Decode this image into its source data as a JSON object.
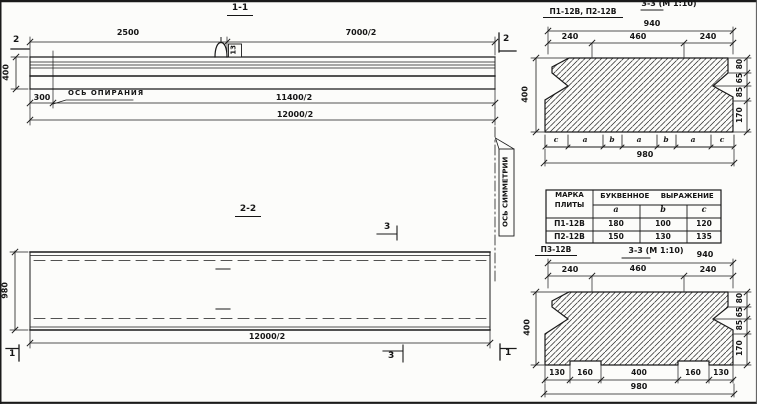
{
  "section_1_1": {
    "title": "1-1",
    "dim_left_span": "2500",
    "dim_right_span": "7000/2",
    "loop_mark": "13",
    "height_dim": "400",
    "support_offset_dim": "300",
    "support_axis_label": "ОСЬ ОПИРАНИЯ",
    "dim_support_span": "11400/2",
    "dim_total": "12000/2",
    "cut_marker_left": "2",
    "cut_marker_right": "2"
  },
  "section_2_2": {
    "title": "2-2",
    "width_dim": "980",
    "dim_total": "12000/2",
    "cut_marker_left": "1",
    "cut_marker_right": "1",
    "cut_marker_top": "3",
    "cut_marker_bottom": "3",
    "symmetry_axis_label": "ОСЬ СИММЕТРИИ"
  },
  "section_3_3_top": {
    "label": "П1-12В, П2-12В",
    "title": "3-3 (М 1:10)",
    "dim_940": "940",
    "dim_240_left": "240",
    "dim_460": "460",
    "dim_240_right": "240",
    "dim_400": "400",
    "right_dims": [
      "80",
      "65",
      "85",
      "170"
    ],
    "letters": [
      "c",
      "a",
      "b",
      "a",
      "b",
      "a",
      "c"
    ],
    "dim_980": "980"
  },
  "plate_table": {
    "header_col1_line1": "МАРКА",
    "header_col1_line2": "ПЛИТЫ",
    "header_expr": "БУКВЕННОЕ ВЫРАЖЕНИЕ",
    "sub_a": "a",
    "sub_b": "b",
    "sub_c": "c",
    "rows": [
      {
        "mark": "П1-12В",
        "a": "180",
        "b": "100",
        "c": "120"
      },
      {
        "mark": "П2-12В",
        "a": "150",
        "b": "130",
        "c": "135"
      }
    ]
  },
  "section_3_3_bottom": {
    "label": "П3-12В",
    "title": "3-3 (М 1:10)",
    "dim_940": "940",
    "dim_240_left": "240",
    "dim_460": "460",
    "dim_240_right": "240",
    "dim_400": "400",
    "right_dims": [
      "80",
      "65",
      "85",
      "170"
    ],
    "bottom_dims": [
      "130",
      "160",
      "400",
      "160",
      "130"
    ],
    "dim_980": "980"
  }
}
